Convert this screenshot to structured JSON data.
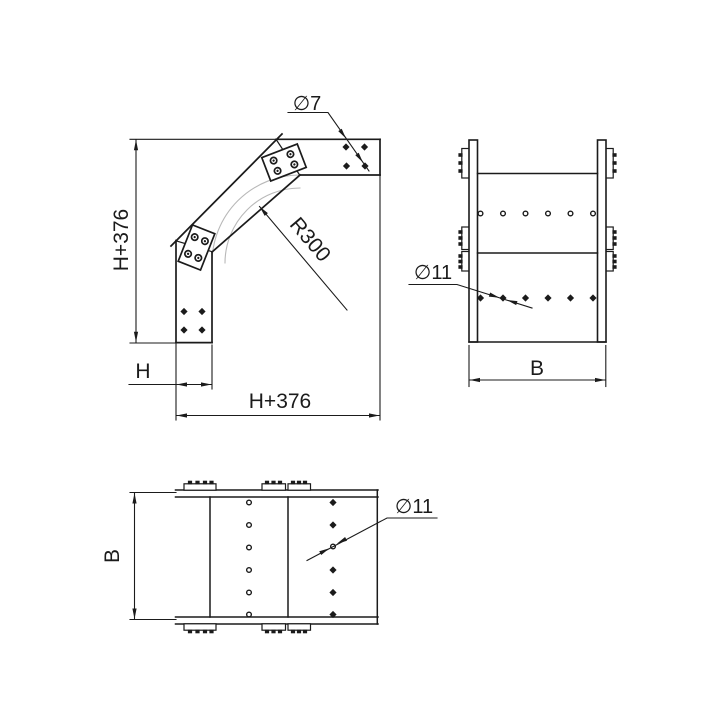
{
  "page": {
    "background": "#ffffff",
    "line_color": "#1b1b1b",
    "arc_color": "#b8b8b8"
  },
  "side_view": {
    "dia7_label": "∅7",
    "radius_label": "R300",
    "height_dim_label": "H+376",
    "leg_width_dim_label": "H",
    "width_dim_label": "H+376"
  },
  "front_view": {
    "dia11_label": "∅11",
    "width_dim_label": "B"
  },
  "bottom_view": {
    "dia11_label": "∅11",
    "height_dim_label": "B"
  }
}
